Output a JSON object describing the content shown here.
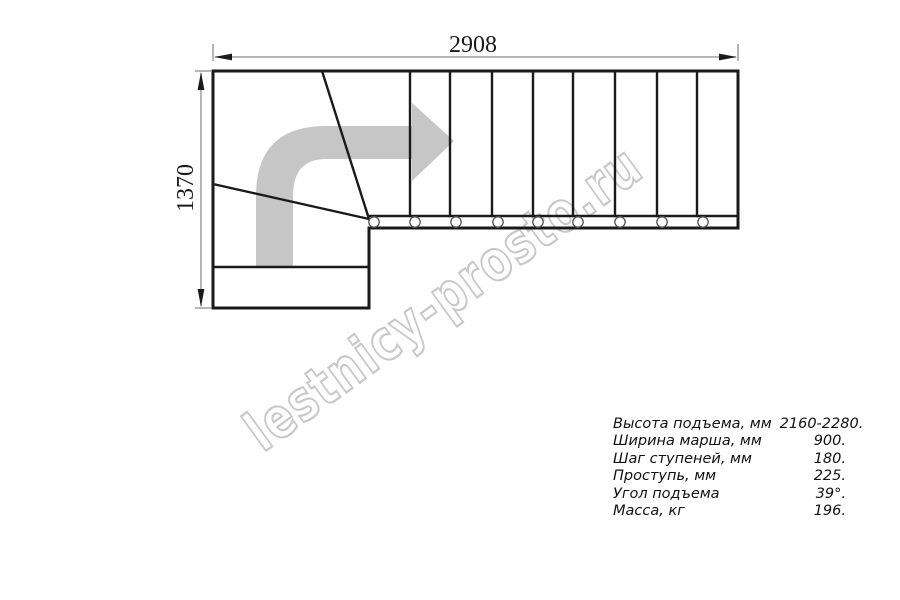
{
  "watermark": {
    "text": "lestnicy-prosto.ru"
  },
  "dimensions": {
    "width_mm": "2908",
    "height_mm": "1370"
  },
  "specs": {
    "rows": [
      {
        "label": "Высота подъема, мм",
        "value": "2160-2280."
      },
      {
        "label": "Ширина марша, мм",
        "value": "900."
      },
      {
        "label": "Шаг ступеней, мм",
        "value": "180."
      },
      {
        "label": "Проступь, мм",
        "value": "225."
      },
      {
        "label": "Угол подъема",
        "value": "39°."
      },
      {
        "label": "Масса, кг",
        "value": "196."
      }
    ]
  },
  "colors": {
    "line": "#1a1a1a",
    "arrow": "#c6c6c6",
    "watermark_outline": "#c8c8c8",
    "dimension_line": "#8c8c8c"
  }
}
